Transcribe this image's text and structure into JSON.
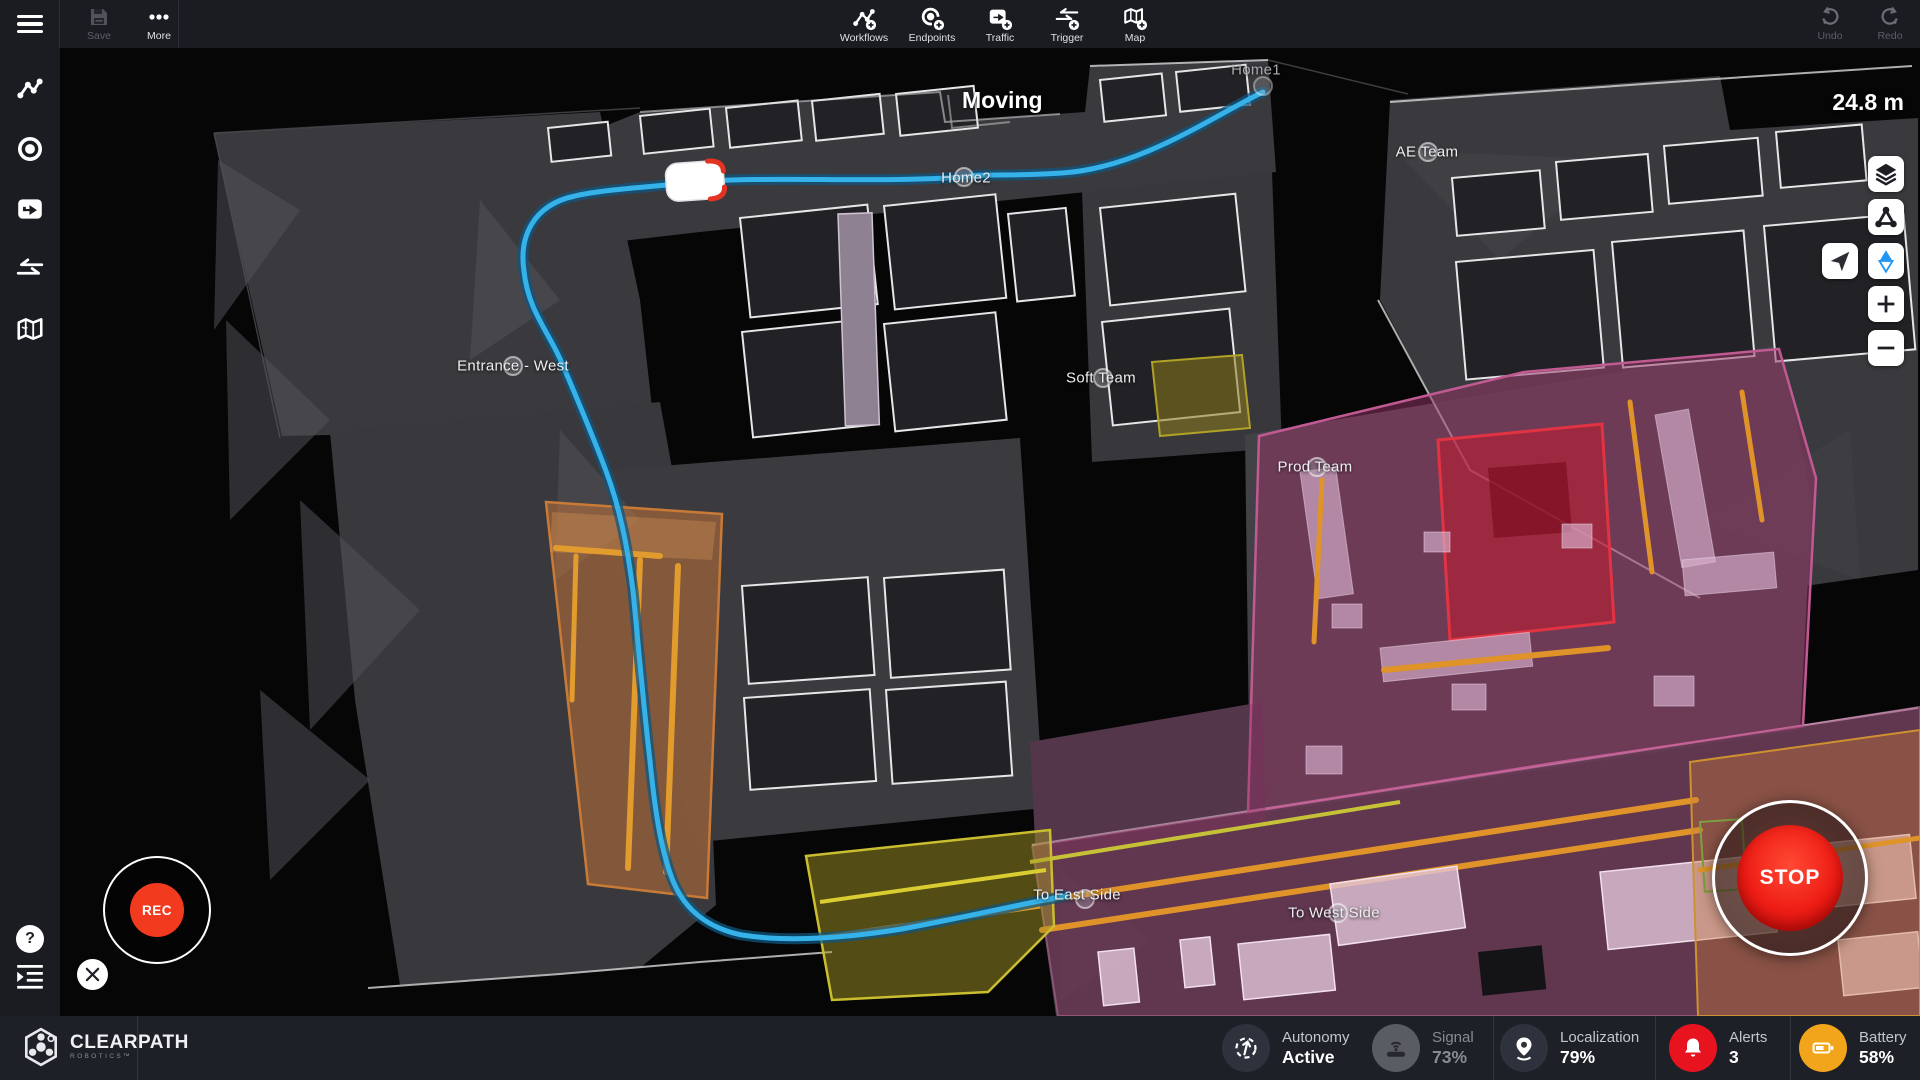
{
  "topbar": {
    "save": "Save",
    "more": "More",
    "tools": [
      {
        "label": "Workflows"
      },
      {
        "label": "Endpoints"
      },
      {
        "label": "Traffic"
      },
      {
        "label": "Trigger"
      },
      {
        "label": "Map"
      }
    ],
    "undo": "Undo",
    "redo": "Redo"
  },
  "map": {
    "status": "Moving",
    "distance": "24.8 m",
    "labels": [
      {
        "text": "Home1"
      },
      {
        "text": "Home2"
      },
      {
        "text": "Entrance - West"
      },
      {
        "text": "Soft Team"
      },
      {
        "text": "Prod Team"
      },
      {
        "text": "AE Team"
      },
      {
        "text": "To East Side"
      },
      {
        "text": "To West Side"
      }
    ],
    "rec": "REC",
    "stop": "STOP"
  },
  "statusbar": {
    "brand": "CLEARPATH",
    "brand_sub": "ROBOTICS™",
    "chips": [
      {
        "label": "Autonomy",
        "value": "Active"
      },
      {
        "label": "Signal",
        "value": "73%"
      },
      {
        "label": "Localization",
        "value": "79%"
      },
      {
        "label": "Alerts",
        "value": "3"
      },
      {
        "label": "Battery",
        "value": "58%"
      }
    ]
  },
  "colors": {
    "path_blue": "#35b2e9",
    "alert_red": "#e7131f",
    "battery_amber": "#f2a51b",
    "rec_red": "#f23a1f",
    "stop_red": "#e01212",
    "zone_orange": "#c87a36",
    "zone_purple": "#983668",
    "zone_yellow": "#cabe30",
    "zone_red": "#e23343"
  }
}
